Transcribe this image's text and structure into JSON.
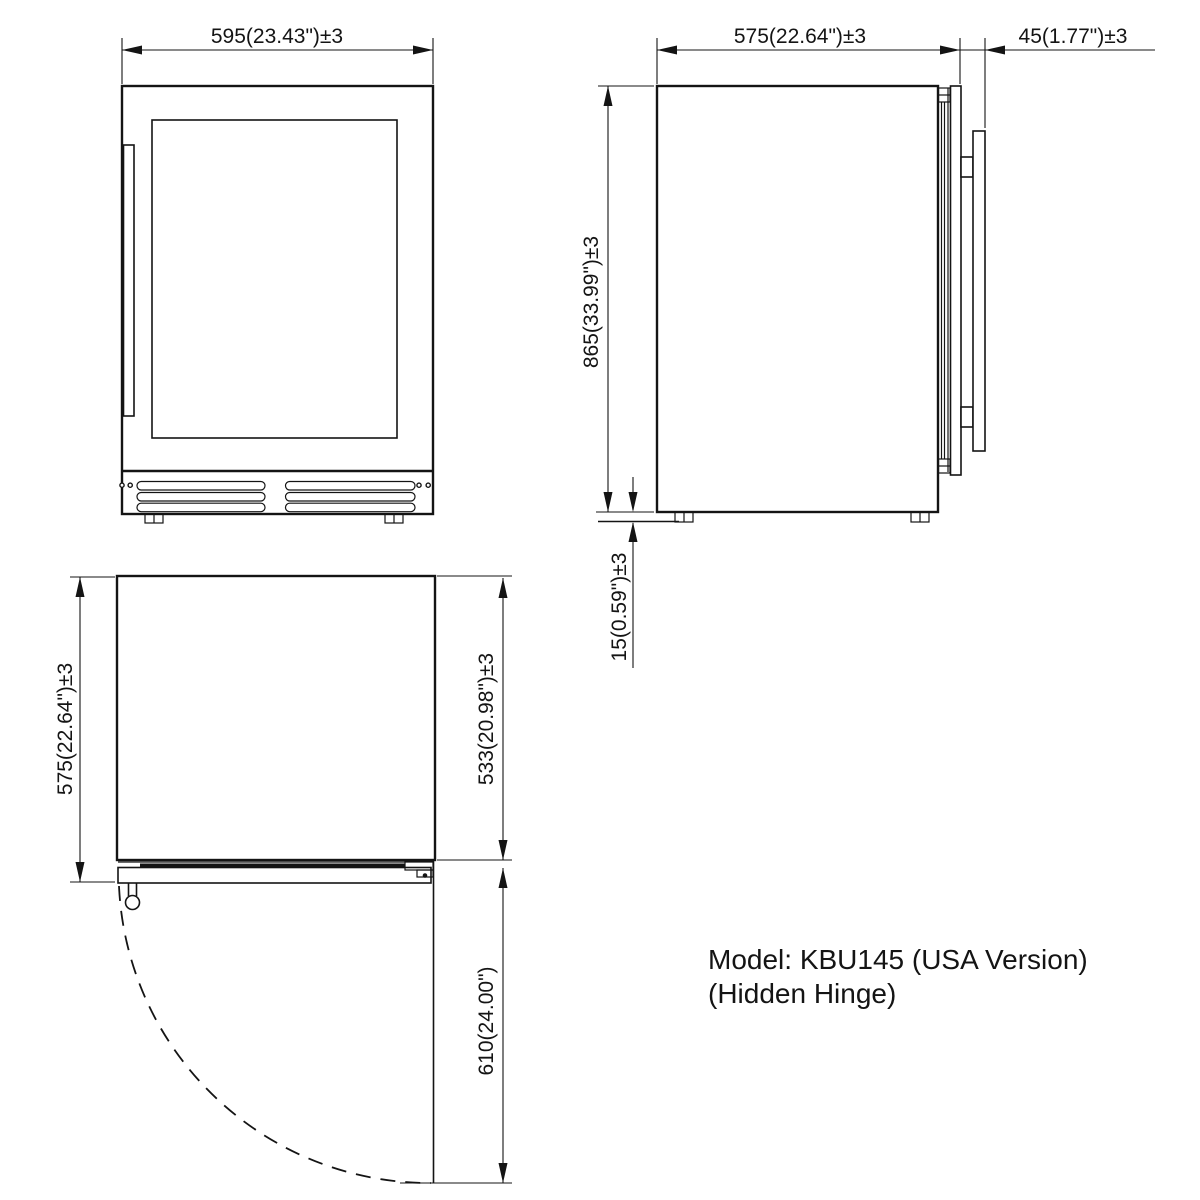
{
  "drawing": {
    "title_model_line1": "Model: KBU145 (USA Version)",
    "title_model_line2": "(Hidden Hinge)",
    "line_color": "#141414",
    "background": "#ffffff",
    "front_view": {
      "width_label": "595(23.43\")±3"
    },
    "side_view": {
      "depth_label": "575(22.64\")±3",
      "door_thickness_label": "45(1.77\")±3",
      "height_label": "865(33.99\")±3",
      "leg_height_label": "15(0.59\")±3"
    },
    "top_view": {
      "depth_label": "575(22.64\")±3",
      "body_depth_label": "533(20.98\")±3",
      "door_swing_label": "610(24.00\")"
    }
  }
}
